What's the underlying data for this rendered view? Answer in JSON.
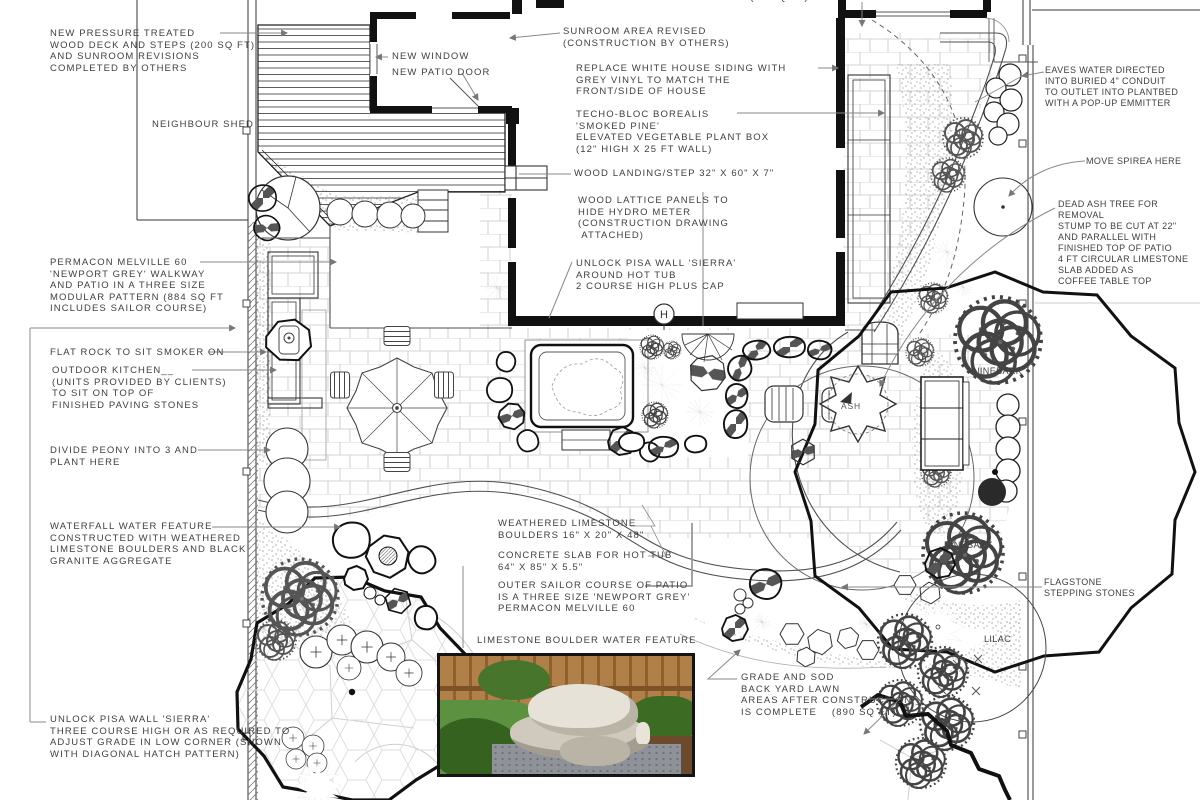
{
  "colors": {
    "ink": "#1a1a1a",
    "leader_gray": "#8a8a8a",
    "paver_gray": "#c6c6c6",
    "photo_fence": "#b08048",
    "photo_grass": "#5c9140",
    "photo_stone": "#cfcabd",
    "photo_gravel": "#8f9298"
  },
  "annotations": {
    "deck": "NEW PRESSURE TREATED\nWOOD DECK AND STEPS (200 SQ FT)\nAND SUNROOM REVISIONS\nCOMPLETED BY OTHERS",
    "new_window": "NEW WINDOW",
    "new_patio_door": "NEW PATIO DOOR",
    "sunroom": "SUNROOM AREA REVISED\n(CONSTRUCTION BY OTHERS)",
    "siding": "REPLACE WHITE HOUSE SIDING WITH\nGREY VINYL TO MATCH THE\nFRONT/SIDE OF HOUSE",
    "veg_box": "TECHO-BLOC BOREALIS\n'SMOKED PINE'\nELEVATED VEGETABLE PLANT BOX\n(12\" HIGH X 25 FT WALL)",
    "landing": "WOOD LANDING/STEP 32\" X 60\" X 7\"",
    "lattice": "WOOD LATTICE PANELS TO\nHIDE HYDRO METER\n(CONSTRUCTION DRAWING\n ATTACHED)",
    "pisa_hot_tub": "UNLOCK PISA WALL 'SIERRA'\nAROUND HOT TUB\n2 COURSE HIGH PLUS CAP",
    "eaves": "EAVES WATER DIRECTED\nINTO BURIED 4\" CONDUIT\nTO OUTLET INTO PLANTBED\nWITH A POP-UP EMMITTER",
    "spirea": "MOVE SPIREA HERE",
    "dead_ash": "DEAD ASH TREE FOR\nREMOVAL\nSTUMP TO BE CUT AT 22\"\nAND PARALLEL WITH\nFINISHED TOP OF PATIO\n4 FT CIRCULAR LIMESTONE\nSLAB ADDED AS\nCOFFEE TABLE TOP",
    "permacon": "PERMACON MELVILLE 60\n'NEWPORT GREY' WALKWAY\nAND PATIO IN A THREE SIZE\nMODULAR PATTERN (884 SQ FT\nINCLUDES SAILOR COURSE)",
    "flat_rock": "FLAT ROCK TO SIT SMOKER ON",
    "kitchen": "OUTDOOR KITCHEN__\n(UNITS PROVIDED BY CLIENTS)\nTO SIT ON TOP OF\nFINISHED PAVING STONES",
    "peony": "DIVIDE PEONY INTO 3 AND\nPLANT HERE",
    "waterfall": "WATERFALL WATER FEATURE\nCONSTRUCTED WITH WEATHERED\nLIMESTONE BOULDERS AND BLACK\nGRANITE AGGREGATE",
    "pisa_low_corner": "UNLOCK PISA WALL 'SIERRA'\nTHREE COURSE HIGH OR AS REQUIRED TO\nADJUST GRADE IN LOW CORNER (SHOWN\nWITH DIAGONAL HATCH PATTERN)",
    "boulders": "WEATHERED LIMESTONE\nBOULDERS 16\" X 20\" X 48\"",
    "slab": "CONCRETE SLAB FOR HOT TUB\n64\" X 85\" X 5.5\"",
    "sailor": "OUTER SAILOR COURSE OF PATIO\nIS A THREE SIZE 'NEWPORT GREY'\nPERMACON MELVILLE 60",
    "photo_caption": "LIMESTONE BOULDER WATER FEATURE",
    "grade_sod": "GRADE AND SOD\nBACK YARD LAWN\nAREAS AFTER CONSTRUCTION __\nIS COMPLETE    (890 SQ FT)",
    "concrete_slab_top": "CONCRETE SLAB (26 SQ FT)"
  },
  "plan_labels": {
    "neighbour_shed": "NEIGHBOUR SHED",
    "ninebark_upper": "NINEBARK",
    "ash": "ASH",
    "ninebark_lower": "NINEBARK",
    "lilac": "LILAC",
    "flagstone": "FLAGSTONE\nSTEPPING STONES",
    "hydro_meter": "H"
  }
}
